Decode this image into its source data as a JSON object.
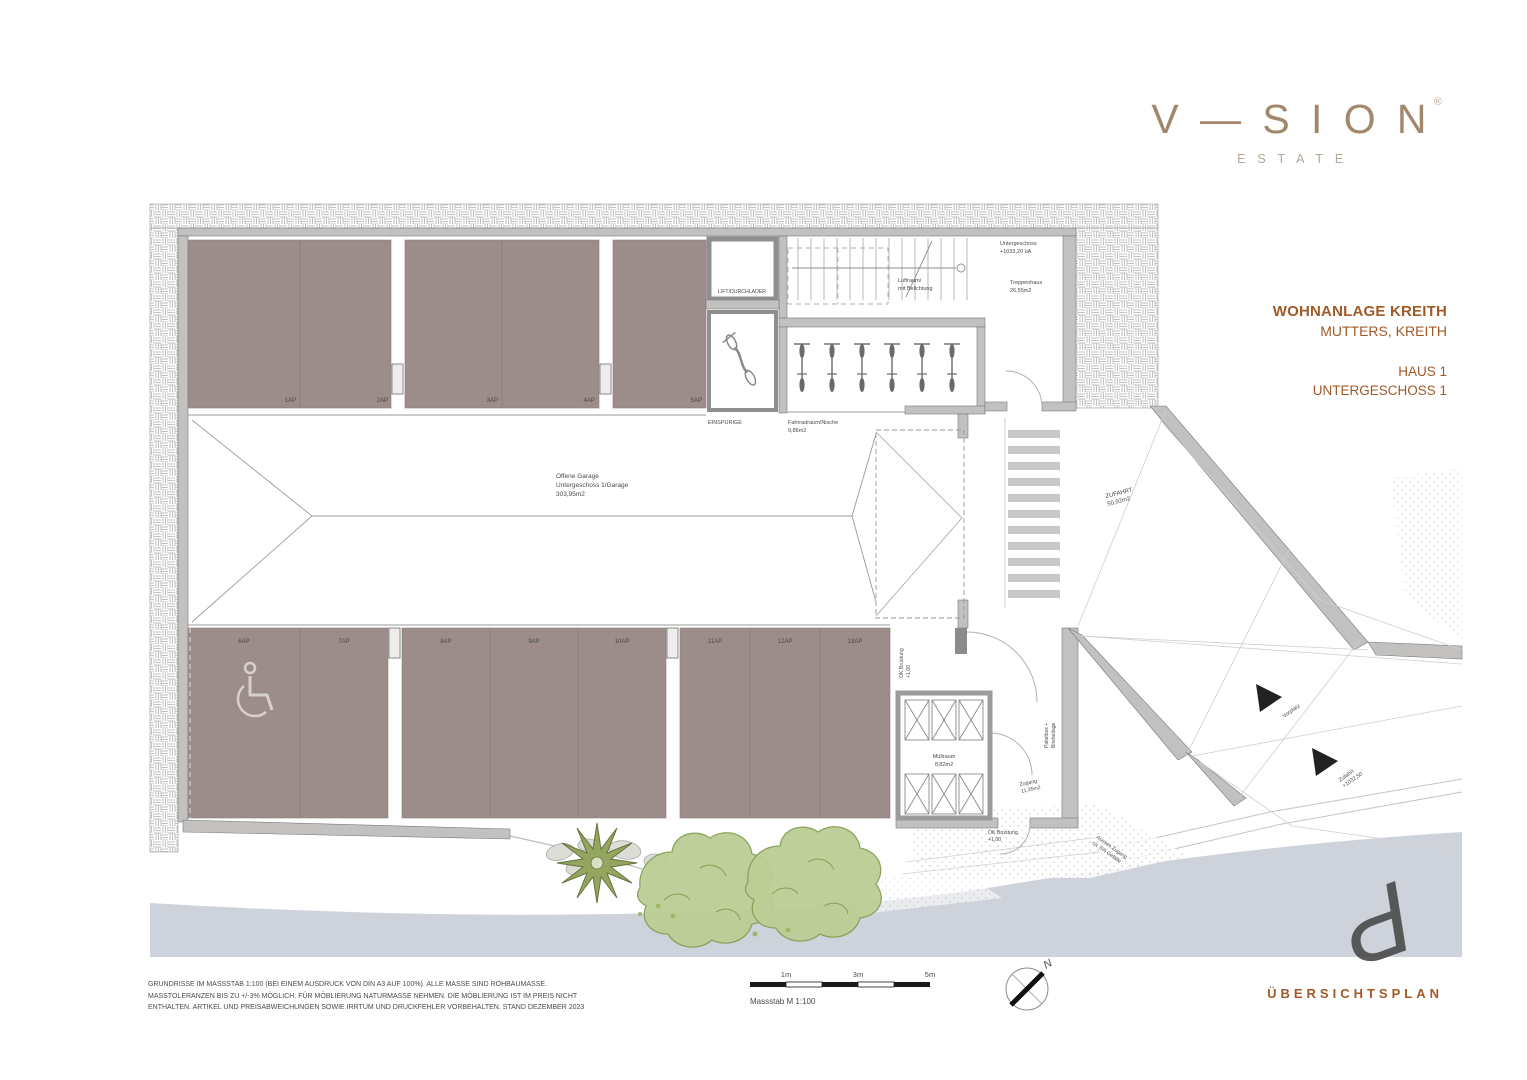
{
  "brand": {
    "name": "V—SION",
    "mark": "®",
    "subtitle": "ESTATE"
  },
  "project": {
    "title": "WOHNANLAGE KREITH",
    "location": "MUTTERS, KREITH",
    "building": "HAUS 1",
    "floor": "UNTERGESCHOSS 1"
  },
  "plan": {
    "lift_label": "LIFT/DURCHLADER",
    "stair_level_line1": "Untergeschoss",
    "stair_level_line2": "+1033,20 üA",
    "luftraum_line1": "Luftraum/",
    "luftraum_line2": "mit Belichtung",
    "treppenhaus_line1": "Treppenhaus",
    "treppenhaus_line2": "26,55m2",
    "einspurige_label": "EINSPURIGE",
    "fahrrad_line1": "Fahrradraum/Nische",
    "fahrrad_line2": "9,86m2",
    "garage_line1": "Offene Garage",
    "garage_line2": "Untergeschoss 1/Garage",
    "garage_line3": "303,95m2",
    "zufahrt_line1": "ZUFAHRT",
    "zufahrt_line2": "50,92m2",
    "muellraum_line1": "Müllraum",
    "muellraum_line2": "8,82m2",
    "paketbox_line1": "Paketbox +",
    "paketbox_line2": "Briefanlage",
    "zugang_line1": "Zugang",
    "zugang_line2": "11,35m2",
    "ok_bruestung_line1": "OK Brüstung",
    "ok_bruestung_line2": "+1,00",
    "vorplatz_label": "Vorplatz",
    "zufahrt_arrow_line1": "Zufahrt",
    "zufahrt_arrow_line2": "+1032,50",
    "aussen_line1": "Aussen Zugang",
    "aussen_line2": "ca. 6% Gefälle",
    "parking_top": [
      "1AP",
      "2AP",
      "3AP",
      "4AP",
      "5AP"
    ],
    "parking_bottom": [
      "6AP",
      "7AP",
      "8AP",
      "9AP",
      "10AP",
      "11AP",
      "12AP",
      "13AP"
    ]
  },
  "footer": {
    "disclaimer": [
      "GRUNDRISSE IM MASSSTAB 1:100 (BEI EINEM AUSDRUCK VON DIN A3 AUF 100%). ALLE MASSE SIND ROHBAUMASSE.",
      "MASSTOLERANZEN BIS ZU +/-3% MÖGLICH. FÜR MÖBLIERUNG NATURMASSE NEHMEN. DIE MÖBLIERUNG IST IM PREIS NICHT",
      "ENTHALTEN. ARTIKEL UND PREISABWEICHUNGEN SOWIE IRRTUM UND DRUCKFEHLER VORBEHALTEN. STAND DEZEMBER 2023"
    ],
    "scale_ticks": [
      "1m",
      "3m",
      "5m"
    ],
    "scale_label": "Massstab M 1:100",
    "north_label": "N",
    "plan_type": "ÜBERSICHTSPLAN"
  },
  "colors": {
    "accent_brown": "#a05a28",
    "logo_taupe": "#a1886a",
    "stall_fill": "#9c8d8b",
    "wall_gray": "#c2c1c0",
    "road_gray": "#ced2da",
    "tree_green": "#bccd95"
  }
}
